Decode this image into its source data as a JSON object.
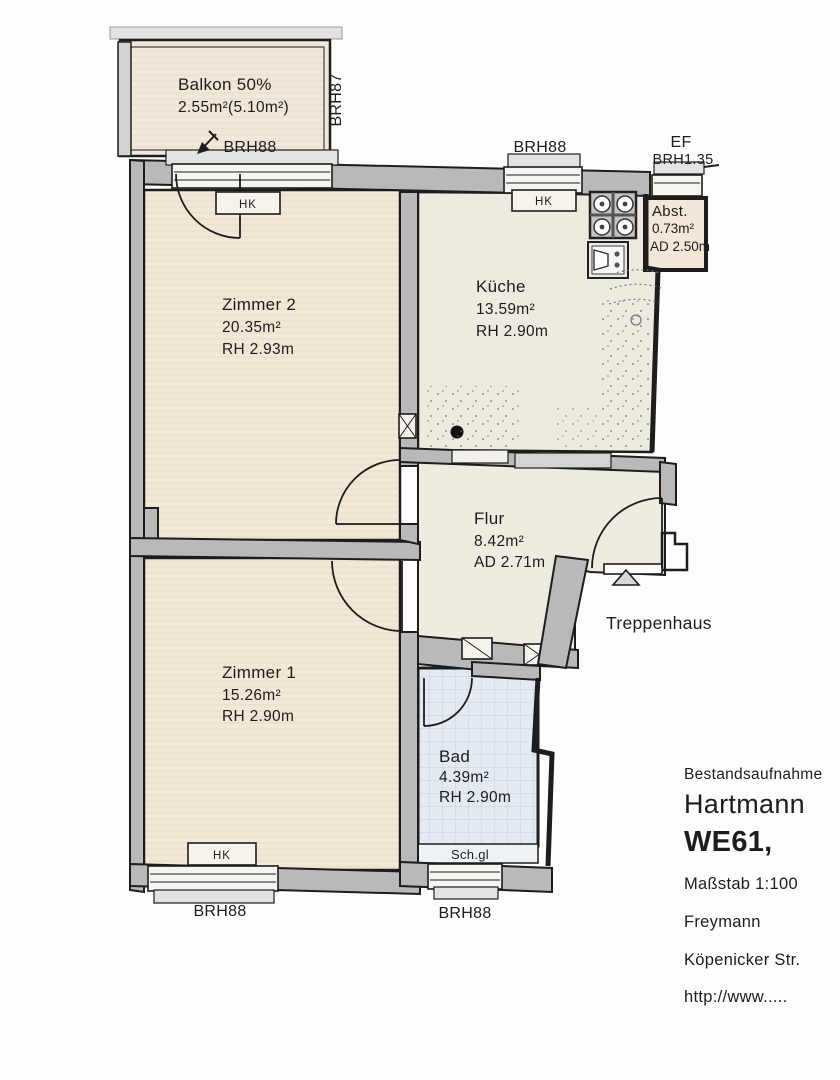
{
  "document_type": "floor-plan",
  "colors": {
    "wall_gray": "#b9b9b9",
    "wall_gray_light": "#d2d2d2",
    "room_beige": "#f3e8d7",
    "room_cream": "#efeae0",
    "bath_blue": "#e4eaf2",
    "tile_line": "#c5d1e2",
    "line_black": "#1d1d1d",
    "window_fill": "#f7f5f0"
  },
  "rooms": {
    "balkon": {
      "name": "Balkon 50%",
      "area": "2.55m²(5.10m²)"
    },
    "zimmer2": {
      "name": "Zimmer 2",
      "area": "20.35m²",
      "height": "RH 2.93m"
    },
    "kueche": {
      "name": "Küche",
      "area": "13.59m²",
      "height": "RH 2.90m"
    },
    "abstellraum": {
      "name": "Abst.",
      "area": "0.73m²",
      "height": "AD 2.50m"
    },
    "flur": {
      "name": "Flur",
      "area": "8.42m²",
      "height": "AD 2.71m"
    },
    "zimmer1": {
      "name": "Zimmer 1",
      "area": "15.26m²",
      "height": "RH 2.90m"
    },
    "bad": {
      "name": "Bad",
      "area": "4.39m²",
      "height": "RH 2.90m"
    },
    "treppenhaus": {
      "name": "Treppenhaus"
    }
  },
  "window_labels": {
    "balkon_side": "BRH87",
    "balkon_door": "BRH88",
    "kueche_top": "BRH88",
    "abst_top_line1": "EF",
    "abst_top_line2": "BRH1.35",
    "zimmer1_bottom": "BRH88",
    "bad_bottom": "BRH88"
  },
  "fixtures": {
    "radiator": "HK",
    "shaft": "Sch.gl"
  },
  "title_block": {
    "survey_type": "Bestandsaufnahme",
    "client": "Hartmann",
    "unit": "WE61,",
    "scale": "Maßstab 1:100",
    "surveyor": "Freymann",
    "street": "Köpenicker Str.",
    "url": "http://www....."
  }
}
